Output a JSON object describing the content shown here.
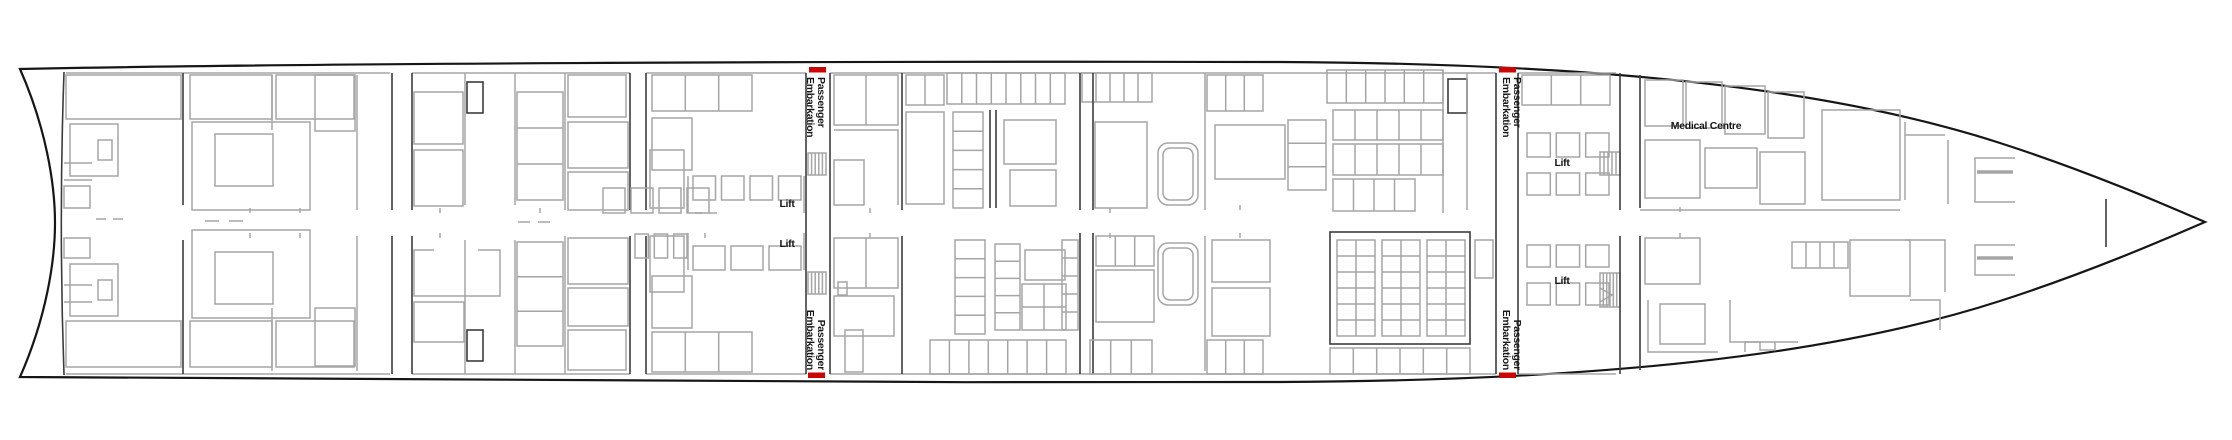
{
  "colors": {
    "background": "#ffffff",
    "hull_line": "#161616",
    "wall_gray": "#a5a5a5",
    "wall_dark": "#3c3c3c",
    "accent_red": "#cb0404",
    "label_text": "#161616"
  },
  "labels": {
    "passenger_embarkation": {
      "line1": "Passenger",
      "line2": "Embarkation"
    },
    "lift": "Lift",
    "medical_centre": "Medical Centre"
  },
  "markers": {
    "embarkation_marker_count": 4,
    "lift_label_count": 4
  }
}
